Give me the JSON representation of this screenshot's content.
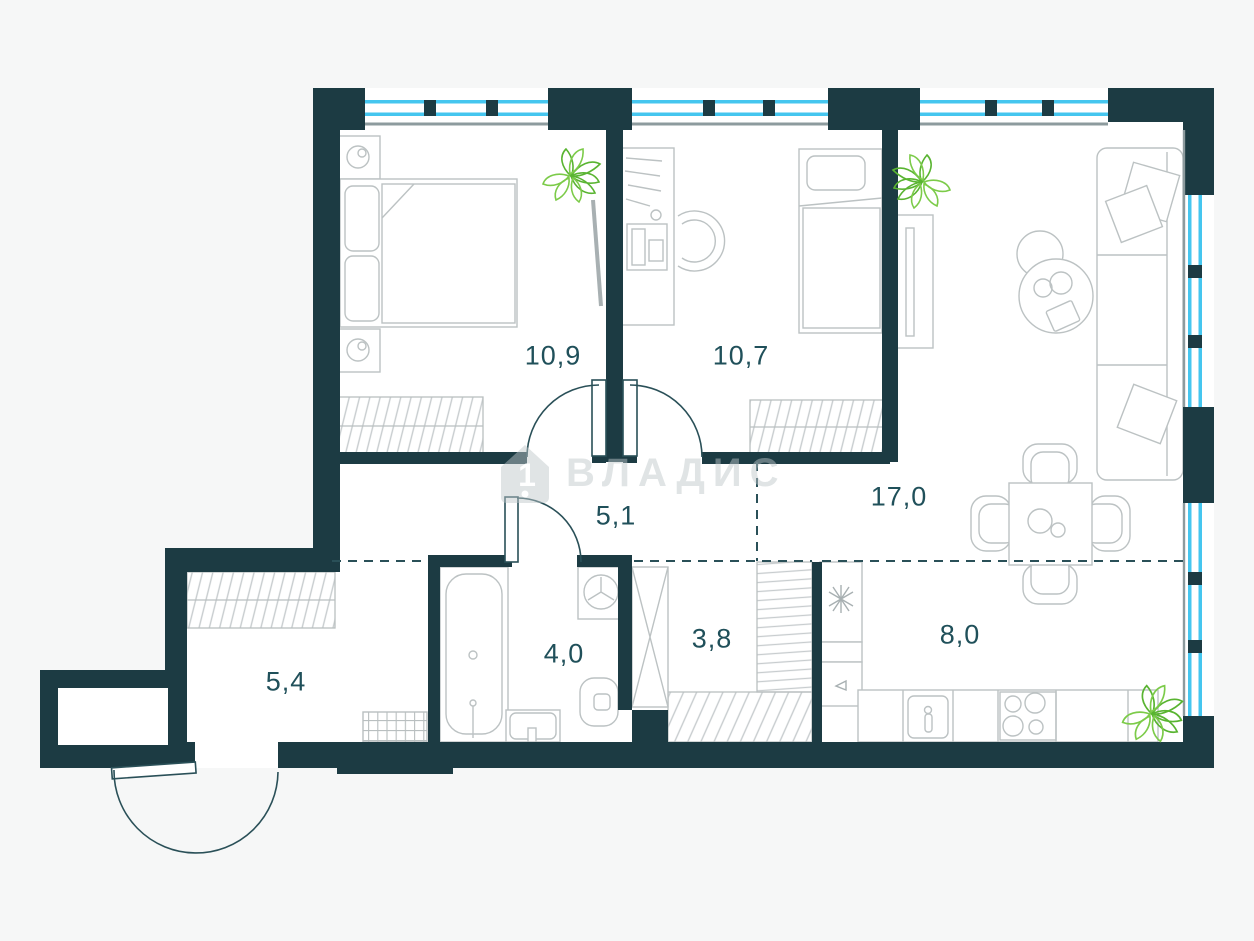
{
  "watermark": {
    "brand": "ВЛАДИС"
  },
  "rooms": [
    {
      "name": "bedroom-1",
      "area_label": "10,9"
    },
    {
      "name": "bedroom-2",
      "area_label": "10,7"
    },
    {
      "name": "living-room",
      "area_label": "17,0"
    },
    {
      "name": "hallway",
      "area_label": "5,1"
    },
    {
      "name": "bathroom",
      "area_label": "4,0"
    },
    {
      "name": "storage",
      "area_label": "3,8"
    },
    {
      "name": "kitchen",
      "area_label": "8,0"
    },
    {
      "name": "entry-hall",
      "area_label": "5,4"
    }
  ],
  "colors": {
    "wall": "#1c3b43",
    "window_glass": "#45c6ef",
    "label_text": "#20505a",
    "plant_green": "#5cb832",
    "furniture_line": "#bcc2c3",
    "background": "#f6f7f7"
  }
}
